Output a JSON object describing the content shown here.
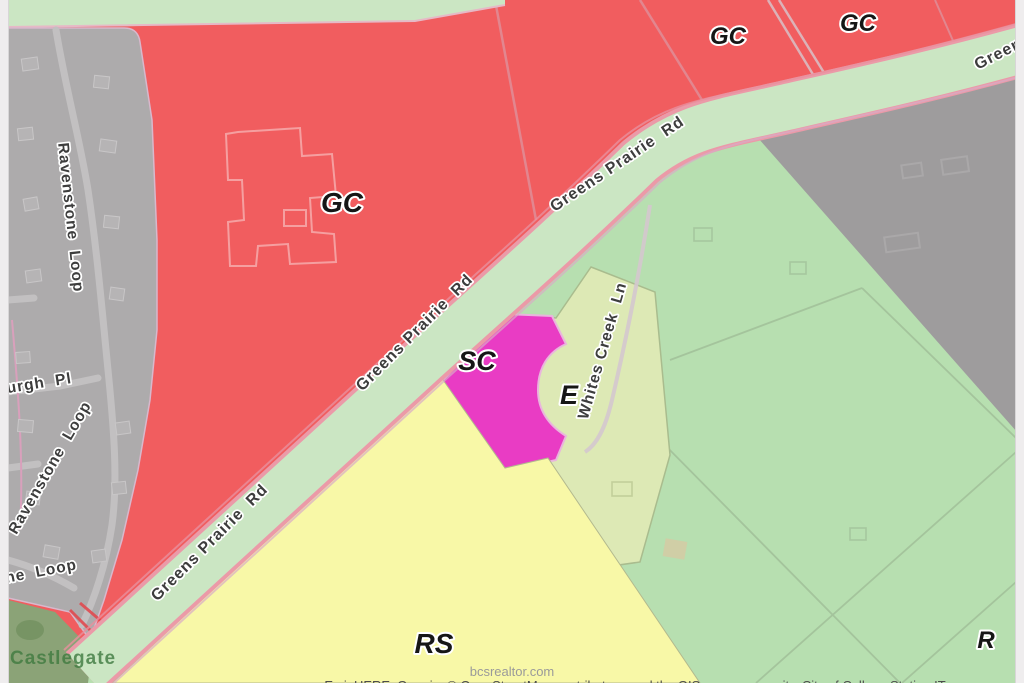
{
  "zones": {
    "gc": {
      "label": "GC",
      "color": "#f15d5f"
    },
    "sc": {
      "label": "SC",
      "color": "#e93cc4"
    },
    "e": {
      "label": "E",
      "color": "#dde9b5"
    },
    "rs": {
      "label": "RS",
      "color": "#f8f8a7"
    },
    "r": {
      "label": "R",
      "color": "#b7dfb0"
    },
    "road_buffer_color": "#cbe6c3",
    "residential_color": "#adabac",
    "unzoned_color": "#9e9c9d",
    "greenbelt_color": "#8ba377"
  },
  "roads": {
    "greens_prairie_rd": "Greens Prairie  Rd",
    "greens_prairie_clipped": "Greens",
    "whites_creek_ln": "Whites Creek  Ln",
    "ravenstone_loop": "Ravenstone  Loop",
    "pl_street_partial": "urgh  Pl",
    "loop_street_partial": "ne  Loop"
  },
  "annotations": {
    "neighborhood": "Castlegate",
    "watermark": "bcsrealtor.com",
    "attribution": "Esri, HERE, Garmin, © OpenStreetMap contributors, and the GIS user community, City of College Station IT"
  }
}
